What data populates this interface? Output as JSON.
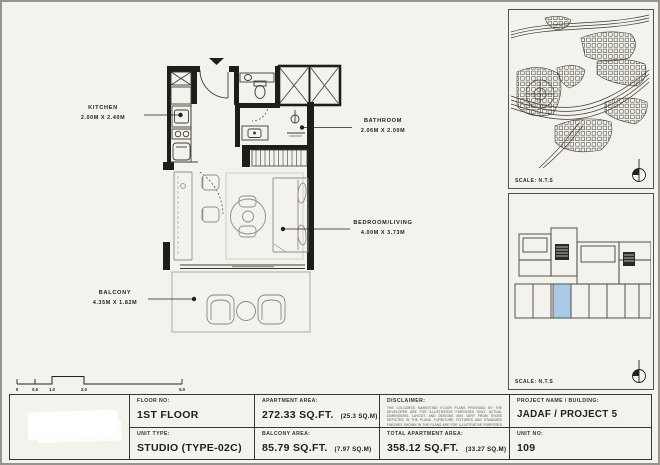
{
  "plan": {
    "rooms": [
      {
        "name": "KITCHEN",
        "dims": "2.00M X 2.40M"
      },
      {
        "name": "BATHROOM",
        "dims": "2.06M X 2.00M"
      },
      {
        "name": "BEDROOM/LIVING",
        "dims": "4.00M X 3.73M"
      },
      {
        "name": "BALCONY",
        "dims": "4.35M X 1.82M"
      }
    ],
    "scale_bar_ticks": [
      "0",
      "0.5",
      "1.0",
      "2.0",
      "5.0"
    ]
  },
  "side_panels": {
    "site_map_scale": "SCALE: N.T.S",
    "key_plan_scale": "SCALE: N.T.S"
  },
  "title_block": {
    "floor_label": "FLOOR NO:",
    "floor_value": "1ST FLOOR",
    "apartment_area_label": "APARTMENT AREA:",
    "apartment_area_value": "272.33 SQ.FT.",
    "apartment_area_metric": "(25.3 SQ.M)",
    "unit_type_label": "UNIT TYPE:",
    "unit_type_value": "STUDIO (TYPE-02C)",
    "balcony_area_label": "BALCONY AREA:",
    "balcony_area_value": "85.79 SQ.FT.",
    "balcony_area_metric": "(7.97 SQ.M)",
    "disclaimer_label": "DISCLAIMER:",
    "disclaimer_text": "THE COLOURED MARKETING FLOOR PLANS PROVIDED BY THE DEVELOPER ARE FOR ILLUSTRATIVE PURPOSES ONLY. ACTUAL DIMENSIONS, LAYOUT, AND DESIGNS MAY VARY FROM THOSE DEPICTED IN THE PLANS. FURNITURE, FIXTURES AND STANDARD FINISHES SHOWN IN THE PLANS ARE FOR ILLUSTRATIVE PURPOSES ONLY AND ARE NOT INCLUDED IN THE PURCHASE OF UNITS OF THE PROPERTY. THE DEVELOPER RESERVES THE RIGHT TO MAKE MODIFICATIONS, REVISIONS, AND CHANGES TO THE FLOOR PLANS, SPECIFICATIONS, AND FEATURES WITHOUT PRIOR NOTICE.",
    "total_area_label": "TOTAL APARTMENT AREA:",
    "total_area_value": "358.12 SQ.FT.",
    "total_area_metric": "(33.27 SQ.M)",
    "project_label": "PROJECT NAME / BUILDING:",
    "project_value": "JADAF / PROJECT 5",
    "unit_no_label": "UNIT NO:",
    "unit_no_value": "109"
  },
  "colors": {
    "paper": "#f4f2ec",
    "wall": "#1f1d17",
    "highlight_unit": "#a9c9e4"
  }
}
